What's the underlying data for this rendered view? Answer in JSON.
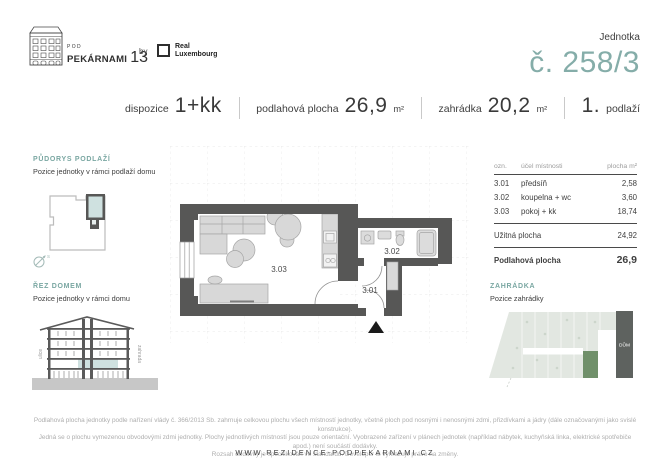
{
  "brand": {
    "building_name_small": "POD",
    "building_name": "PEKÁRNAMI",
    "building_number": "13",
    "by": "by",
    "partner_name_line1": "Real",
    "partner_name_line2": "Luxembourg"
  },
  "unit_header": {
    "label": "Jednotka",
    "number": "č. 258/3"
  },
  "specs": {
    "dispozice_label": "dispozice",
    "dispozice_value": "1+kk",
    "plocha_label": "podlahová plocha",
    "plocha_value": "26,9",
    "plocha_unit": "m²",
    "zahradka_label": "zahrádka",
    "zahradka_value": "20,2",
    "zahradka_unit": "m²",
    "podlazi_value": "1.",
    "podlazi_label": "podlaží"
  },
  "sections": {
    "floorplan_overview": {
      "title": "PŮDORYS PODLAŽÍ",
      "subtitle": "Pozice jednotky v rámci podlaží domu",
      "compass_letter": "S"
    },
    "building_section": {
      "title": "ŘEZ DOMEM",
      "subtitle": "Pozice jednotky v rámci domu",
      "left_label": "ulice",
      "right_label": "zahrada"
    },
    "garden": {
      "title": "ZAHRÁDKA",
      "subtitle": "Pozice zahrádky",
      "house_label": "DŮM"
    }
  },
  "plan_labels": {
    "living": "3.03",
    "bath": "3.02",
    "hall": "3.01"
  },
  "areas_table": {
    "col_ozn": "ozn.",
    "col_ucel": "účel místnosti",
    "col_plocha": "plocha m²",
    "rows": [
      {
        "ozn": "3.01",
        "ucel": "předsíň",
        "plocha": "2,58"
      },
      {
        "ozn": "3.02",
        "ucel": "koupelna + wc",
        "plocha": "3,60"
      },
      {
        "ozn": "3.03",
        "ucel": "pokoj + kk",
        "plocha": "18,74"
      }
    ],
    "subtotal_label": "Užitná plocha",
    "subtotal_value": "24,92",
    "total_label": "Podlahová plocha",
    "total_value": "26,9"
  },
  "footer": {
    "line1": "Podlahová plocha jednotky podle nařízení vlády č. 366/2013 Sb. zahrnuje celkovou plochu všech místností jednotky, včetně ploch pod nosnými i nenosnými zdmi, přizdívkami a jádry (dále označovanými jako svislé konstrukce).",
    "line2": "Jedná se o plochu vymezenou obvodovými zdmi jednotky. Plochy jednotlivých místností jsou pouze orientační. Vyobrazené zařízení v plánech jednotek (například nábytek, kuchyňská linka, elektrické spotřebiče apod.) není součástí dodávky.",
    "line3": "Rozsah dodávky je specifikován ve standardu. Developer si vyhrazuje právo na změny.",
    "website": "WWW.REZIDENCE-PODPEKARNAMI.CZ"
  },
  "colors": {
    "accent": "#7AA7A2",
    "accent_light": "#85ADA9",
    "wall": "#575756",
    "unit_highlight_fill": "#CFE1E0",
    "garden_bg": "#E2E7E1",
    "garden_plot": "#70906A",
    "house_block": "#5E625F"
  }
}
